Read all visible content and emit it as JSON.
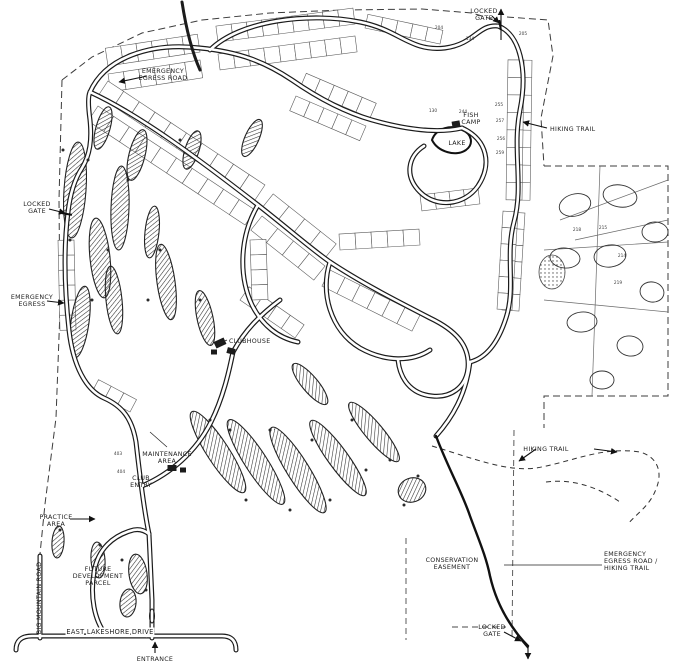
{
  "meta": {
    "canvas_w": 676,
    "canvas_h": 666,
    "ink_color": "#1b1b1b",
    "background_color": "#ffffff"
  },
  "labels": [
    {
      "id": "label-locked-gate-top",
      "lines": [
        "LOCKED",
        "GATE"
      ],
      "x": 484,
      "y": 13,
      "anchor": "middle"
    },
    {
      "id": "label-hiking-trail-right",
      "lines": [
        "HIKING TRAIL"
      ],
      "x": 550,
      "y": 131,
      "anchor": "start"
    },
    {
      "id": "label-fish-camp",
      "lines": [
        "FISH",
        "CAMP"
      ],
      "x": 471,
      "y": 117,
      "anchor": "middle"
    },
    {
      "id": "label-lake",
      "lines": [
        "LAKE"
      ],
      "x": 457,
      "y": 145,
      "anchor": "middle"
    },
    {
      "id": "label-emergency-egress-road-top",
      "lines": [
        "EMERGENCY",
        "EGRESS ROAD"
      ],
      "x": 163,
      "y": 73,
      "anchor": "middle"
    },
    {
      "id": "label-locked-gate-left",
      "lines": [
        "LOCKED",
        "GATE"
      ],
      "x": 37,
      "y": 206,
      "anchor": "middle"
    },
    {
      "id": "label-emergency-egress-left",
      "lines": [
        "EMERGENCY",
        "EGRESS"
      ],
      "x": 32,
      "y": 299,
      "anchor": "middle"
    },
    {
      "id": "label-big-mountain-road",
      "lines": [
        "BIG MOUNTAIN ROAD"
      ],
      "x": 41,
      "y": 598,
      "anchor": "middle",
      "rotate": -90
    },
    {
      "id": "label-practice-area",
      "lines": [
        "PRACTICE",
        "AREA"
      ],
      "x": 56,
      "y": 519,
      "anchor": "middle"
    },
    {
      "id": "label-future-development-parcel",
      "lines": [
        "FUTURE",
        "DEVELOPMENT",
        "PARCEL"
      ],
      "x": 98,
      "y": 571,
      "anchor": "middle"
    },
    {
      "id": "label-east-lakeshore-drive",
      "lines": [
        "EAST LAKESHORE DRIVE"
      ],
      "x": 110,
      "y": 634,
      "anchor": "middle",
      "roadname": true
    },
    {
      "id": "label-entrance",
      "lines": [
        "ENTRANCE"
      ],
      "x": 155,
      "y": 661,
      "anchor": "middle"
    },
    {
      "id": "label-clubhouse",
      "lines": [
        "CLUBHOUSE"
      ],
      "x": 229,
      "y": 343,
      "anchor": "start"
    },
    {
      "id": "label-maintenance-area",
      "lines": [
        "MAINTENANCE",
        "AREA"
      ],
      "x": 167,
      "y": 456,
      "anchor": "middle"
    },
    {
      "id": "label-club-entry",
      "lines": [
        "CLUB",
        "ENTRY"
      ],
      "x": 141,
      "y": 480,
      "anchor": "middle"
    },
    {
      "id": "label-hiking-trail-center",
      "lines": [
        "HIKING TRAIL"
      ],
      "x": 546,
      "y": 451,
      "anchor": "middle"
    },
    {
      "id": "label-conservation-easement",
      "lines": [
        "CONSERVATION",
        "EASEMENT"
      ],
      "x": 452,
      "y": 562,
      "anchor": "middle"
    },
    {
      "id": "label-emergency-egress-hiking-trail",
      "lines": [
        "EMERGENCY",
        "EGRESS ROAD /",
        "HIKING TRAIL"
      ],
      "x": 604,
      "y": 556,
      "anchor": "start"
    },
    {
      "id": "label-locked-gate-bottom",
      "lines": [
        "LOCKED",
        "GATE"
      ],
      "x": 492,
      "y": 629,
      "anchor": "middle"
    }
  ],
  "lot_numbers": [
    {
      "n": "204",
      "x": 439,
      "y": 29
    },
    {
      "n": "134",
      "x": 470,
      "y": 40
    },
    {
      "n": "205",
      "x": 523,
      "y": 35
    },
    {
      "n": "130",
      "x": 433,
      "y": 112
    },
    {
      "n": "244",
      "x": 463,
      "y": 113
    },
    {
      "n": "255",
      "x": 499,
      "y": 106
    },
    {
      "n": "257",
      "x": 500,
      "y": 122
    },
    {
      "n": "256",
      "x": 501,
      "y": 140
    },
    {
      "n": "259",
      "x": 500,
      "y": 154
    },
    {
      "n": "218",
      "x": 577,
      "y": 231
    },
    {
      "n": "215",
      "x": 603,
      "y": 229
    },
    {
      "n": "214",
      "x": 622,
      "y": 257
    },
    {
      "n": "219",
      "x": 618,
      "y": 284
    },
    {
      "n": "403",
      "x": 118,
      "y": 455
    },
    {
      "n": "404",
      "x": 121,
      "y": 473
    }
  ],
  "map": {
    "boundaries": [
      "M62,80 L92,57 L142,33 L202,20 L270,13 L342,10 L422,9 L472,13 L495,20",
      "M507,17 L548,20 L553,56 L541,118 L544,166",
      "M544,166 L668,166 L668,396 L544,396 L544,428",
      "M62,80 L59,200 L60,310 L56,418 L45,504 L40,554"
    ],
    "trails": [
      "M520,56 L520,166",
      "M432,446 C472,458 506,472 536,468 C572,462 602,446 640,452 C658,457 663,473 656,489 C650,506 636,514 628,524",
      "M546,482 C576,478 602,490 620,502"
    ],
    "corridors": [
      "M406,538 L406,640",
      "M514,430 L512,640",
      "M452,627 L506,627"
    ],
    "roads": [
      "M16,650 Q16,636 32,636 L222,636 Q236,636 236,650",
      "M40,556 L40,638",
      "M152,638 L152,600 C151,575 150,556 149,534",
      "M106,635 C94,620 90,596 94,572 C98,548 114,536 130,531 C138,528 144,530 149,534",
      "M68,212 C63,252 65,294 69,330 C73,366 86,390 104,398 C122,406 132,418 136,442 C139,468 143,505 149,534",
      "M142,486 C170,474 196,452 211,422 C223,398 229,372 233,352",
      "M90,92 C140,115 200,160 258,205 C290,230 310,248 330,262 C360,282 395,300 430,318 C455,330 470,345 468,368 C466,388 450,398 432,396 C410,394 400,378 398,360",
      "M90,92 C105,58 150,42 200,48 C240,52 265,62 292,80 C318,98 344,112 372,120 C404,129 436,134 462,128",
      "M210,50 C240,20 310,12 360,22 C400,30 410,52 445,48 C475,44 478,24 498,26",
      "M498,26 C520,34 528,70 520,110 C512,150 524,185 514,222 C505,255 516,288 506,318 C498,343 486,358 470,362",
      "M462,128 C488,140 492,165 478,186 C464,206 436,208 420,192 C404,176 408,156 424,146",
      "M258,205 C240,235 238,275 252,305 C262,325 278,338 298,342",
      "M330,262 C320,292 330,330 360,348 C385,362 412,362 430,350",
      "M68,212 C70,195 74,180 82,168 C90,155 92,140 90,120 C88,105 88,96 90,92",
      "M470,362 C466,395 452,418 436,436",
      "M233,352 C245,330 260,315 280,300"
    ],
    "stub_roads": [
      "M182,2 C186,28 192,52 200,70"
    ],
    "conservation_road": "M436,436 C448,468 462,492 470,516 C478,538 486,556 490,576 C495,598 504,616 516,632 C521,639 525,643 528,646",
    "fairways": [
      [
        75,
        190,
        11,
        48,
        4
      ],
      [
        100,
        258,
        10,
        40,
        -6
      ],
      [
        80,
        322,
        9,
        36,
        8
      ],
      [
        120,
        208,
        9,
        42,
        2
      ],
      [
        114,
        300,
        8,
        34,
        -6
      ],
      [
        137,
        155,
        8,
        26,
        14
      ],
      [
        166,
        282,
        9,
        38,
        -8
      ],
      [
        152,
        232,
        7,
        26,
        6
      ],
      [
        192,
        150,
        7,
        20,
        18
      ],
      [
        205,
        318,
        8,
        28,
        -12
      ],
      [
        103,
        128,
        7,
        22,
        16
      ],
      [
        252,
        138,
        7,
        20,
        24
      ],
      [
        218,
        452,
        11,
        48,
        -33
      ],
      [
        256,
        462,
        11,
        50,
        -33
      ],
      [
        298,
        470,
        11,
        50,
        -32
      ],
      [
        338,
        458,
        10,
        46,
        -36
      ],
      [
        374,
        432,
        9,
        38,
        -40
      ],
      [
        310,
        384,
        8,
        26,
        -40
      ],
      [
        412,
        490,
        14,
        12,
        -20
      ],
      [
        138,
        574,
        9,
        20,
        -8
      ],
      [
        128,
        603,
        8,
        14,
        6
      ],
      [
        58,
        542,
        6,
        16,
        4
      ],
      [
        98,
        560,
        7,
        18,
        -4
      ]
    ],
    "stipples": [
      [
        552,
        272,
        13,
        17,
        0
      ]
    ],
    "lake_path": "M432,140 C436,128 452,124 462,130 C472,134 474,144 466,150 C456,157 438,152 432,140 Z",
    "estate_lines": [
      [
        544,
        250,
        668,
        242
      ],
      [
        544,
        300,
        668,
        312
      ],
      [
        560,
        220,
        668,
        180
      ],
      [
        575,
        240,
        668,
        220
      ],
      [
        600,
        166,
        592,
        396
      ]
    ],
    "estate_blobs": [
      [
        575,
        205,
        16,
        11,
        -15
      ],
      [
        620,
        196,
        17,
        11,
        10
      ],
      [
        655,
        232,
        13,
        10,
        0
      ],
      [
        565,
        258,
        15,
        10,
        5
      ],
      [
        610,
        256,
        16,
        11,
        -8
      ],
      [
        652,
        292,
        12,
        10,
        12
      ],
      [
        582,
        322,
        15,
        10,
        -5
      ],
      [
        630,
        346,
        13,
        10,
        8
      ],
      [
        602,
        380,
        12,
        9,
        0
      ]
    ],
    "lot_rows": [
      {
        "x1": 108,
        "y1": 66,
        "x2": 200,
        "y2": 52,
        "d": -18,
        "n": 6
      },
      {
        "x1": 108,
        "y1": 74,
        "x2": 200,
        "y2": 60,
        "d": 18,
        "n": 6
      },
      {
        "x1": 218,
        "y1": 42,
        "x2": 355,
        "y2": 24,
        "d": -16,
        "n": 9
      },
      {
        "x1": 218,
        "y1": 54,
        "x2": 355,
        "y2": 36,
        "d": 16,
        "n": 9
      },
      {
        "x1": 365,
        "y1": 28,
        "x2": 440,
        "y2": 44,
        "d": -14,
        "n": 5
      },
      {
        "x1": 98,
        "y1": 96,
        "x2": 255,
        "y2": 200,
        "d": -18,
        "n": 10
      },
      {
        "x1": 98,
        "y1": 106,
        "x2": 255,
        "y2": 210,
        "d": 18,
        "n": 10
      },
      {
        "x1": 262,
        "y1": 208,
        "x2": 325,
        "y2": 258,
        "d": -18,
        "n": 4
      },
      {
        "x1": 262,
        "y1": 216,
        "x2": 325,
        "y2": 266,
        "d": 18,
        "n": 4
      },
      {
        "x1": 514,
        "y1": 60,
        "x2": 512,
        "y2": 200,
        "d": -18,
        "n": 8
      },
      {
        "x1": 524,
        "y1": 60,
        "x2": 522,
        "y2": 200,
        "d": 16,
        "n": 8
      },
      {
        "x1": 508,
        "y1": 212,
        "x2": 502,
        "y2": 310,
        "d": -17,
        "n": 6
      },
      {
        "x1": 518,
        "y1": 212,
        "x2": 512,
        "y2": 310,
        "d": 15,
        "n": 6
      },
      {
        "x1": 300,
        "y1": 88,
        "x2": 370,
        "y2": 118,
        "d": -16,
        "n": 5
      },
      {
        "x1": 296,
        "y1": 96,
        "x2": 366,
        "y2": 126,
        "d": 16,
        "n": 5
      },
      {
        "x1": 420,
        "y1": 195,
        "x2": 478,
        "y2": 188,
        "d": 16,
        "n": 4
      },
      {
        "x1": 340,
        "y1": 250,
        "x2": 420,
        "y2": 245,
        "d": -16,
        "n": 5
      },
      {
        "x1": 330,
        "y1": 270,
        "x2": 420,
        "y2": 315,
        "d": 18,
        "n": 6
      },
      {
        "x1": 240,
        "y1": 300,
        "x2": 295,
        "y2": 338,
        "d": -16,
        "n": 4
      },
      {
        "x1": 74,
        "y1": 240,
        "x2": 76,
        "y2": 330,
        "d": 16,
        "n": 6
      },
      {
        "x1": 92,
        "y1": 392,
        "x2": 130,
        "y2": 412,
        "d": -14,
        "n": 3
      },
      {
        "x1": 250,
        "y1": 240,
        "x2": 252,
        "y2": 300,
        "d": -16,
        "n": 4
      }
    ],
    "buildings": [
      [
        220,
        343,
        11,
        7,
        -25
      ],
      [
        231,
        351,
        8,
        6,
        15
      ],
      [
        214,
        352,
        6,
        5,
        0
      ],
      [
        172,
        468,
        9,
        6,
        0
      ],
      [
        183,
        470,
        6,
        5,
        0
      ],
      [
        456,
        124,
        8,
        6,
        -10
      ]
    ],
    "medians": [
      [
        152,
        616,
        2.5,
        7
      ]
    ],
    "tree_dots": [
      [
        63,
        150
      ],
      [
        88,
        160
      ],
      [
        70,
        240
      ],
      [
        92,
        300
      ],
      [
        108,
        250
      ],
      [
        128,
        180
      ],
      [
        148,
        300
      ],
      [
        160,
        250
      ],
      [
        180,
        140
      ],
      [
        200,
        300
      ],
      [
        210,
        420
      ],
      [
        230,
        430
      ],
      [
        246,
        500
      ],
      [
        270,
        430
      ],
      [
        290,
        510
      ],
      [
        312,
        440
      ],
      [
        330,
        500
      ],
      [
        352,
        420
      ],
      [
        366,
        470
      ],
      [
        390,
        460
      ],
      [
        404,
        505
      ],
      [
        418,
        476
      ],
      [
        122,
        560
      ],
      [
        146,
        590
      ],
      [
        60,
        530
      ],
      [
        100,
        545
      ]
    ],
    "gates": [
      [
        500,
        25,
        80
      ],
      [
        67,
        214,
        10
      ],
      [
        525,
        644,
        50
      ]
    ],
    "arrows": [
      {
        "id": "north-exit-arrow",
        "x1": 501,
        "y1": 40,
        "x2": 501,
        "y2": 9
      },
      {
        "id": "entrance-arrow",
        "x1": 155,
        "y1": 653,
        "x2": 155,
        "y2": 642
      },
      {
        "id": "hiking-right-arrow",
        "x1": 547,
        "y1": 128,
        "x2": 523,
        "y2": 122
      },
      {
        "id": "hiking-center-left-arrow",
        "x1": 536,
        "y1": 449,
        "x2": 519,
        "y2": 461
      },
      {
        "id": "hiking-center-right-arrow",
        "x1": 594,
        "y1": 449,
        "x2": 617,
        "y2": 452
      },
      {
        "id": "egress-top-arrow",
        "x1": 147,
        "y1": 76,
        "x2": 119,
        "y2": 82
      },
      {
        "id": "locked-left-arrow",
        "x1": 49,
        "y1": 209,
        "x2": 65,
        "y2": 213
      },
      {
        "id": "egress-left-arrow",
        "x1": 47,
        "y1": 301,
        "x2": 64,
        "y2": 303
      },
      {
        "id": "practice-arrow",
        "x1": 70,
        "y1": 519,
        "x2": 95,
        "y2": 519
      },
      {
        "id": "locked-top-leader-arrow",
        "x1": 492,
        "y1": 16,
        "x2": 499,
        "y2": 23
      },
      {
        "id": "locked-bottom-arrow",
        "x1": 504,
        "y1": 632,
        "x2": 521,
        "y2": 641
      },
      {
        "id": "gate-down-arrow",
        "x1": 528,
        "y1": 646,
        "x2": 528,
        "y2": 659
      }
    ],
    "leaders": [
      [
        167,
        447,
        150,
        432
      ],
      [
        602,
        565,
        504,
        565
      ],
      [
        227,
        340,
        218,
        344
      ]
    ]
  }
}
